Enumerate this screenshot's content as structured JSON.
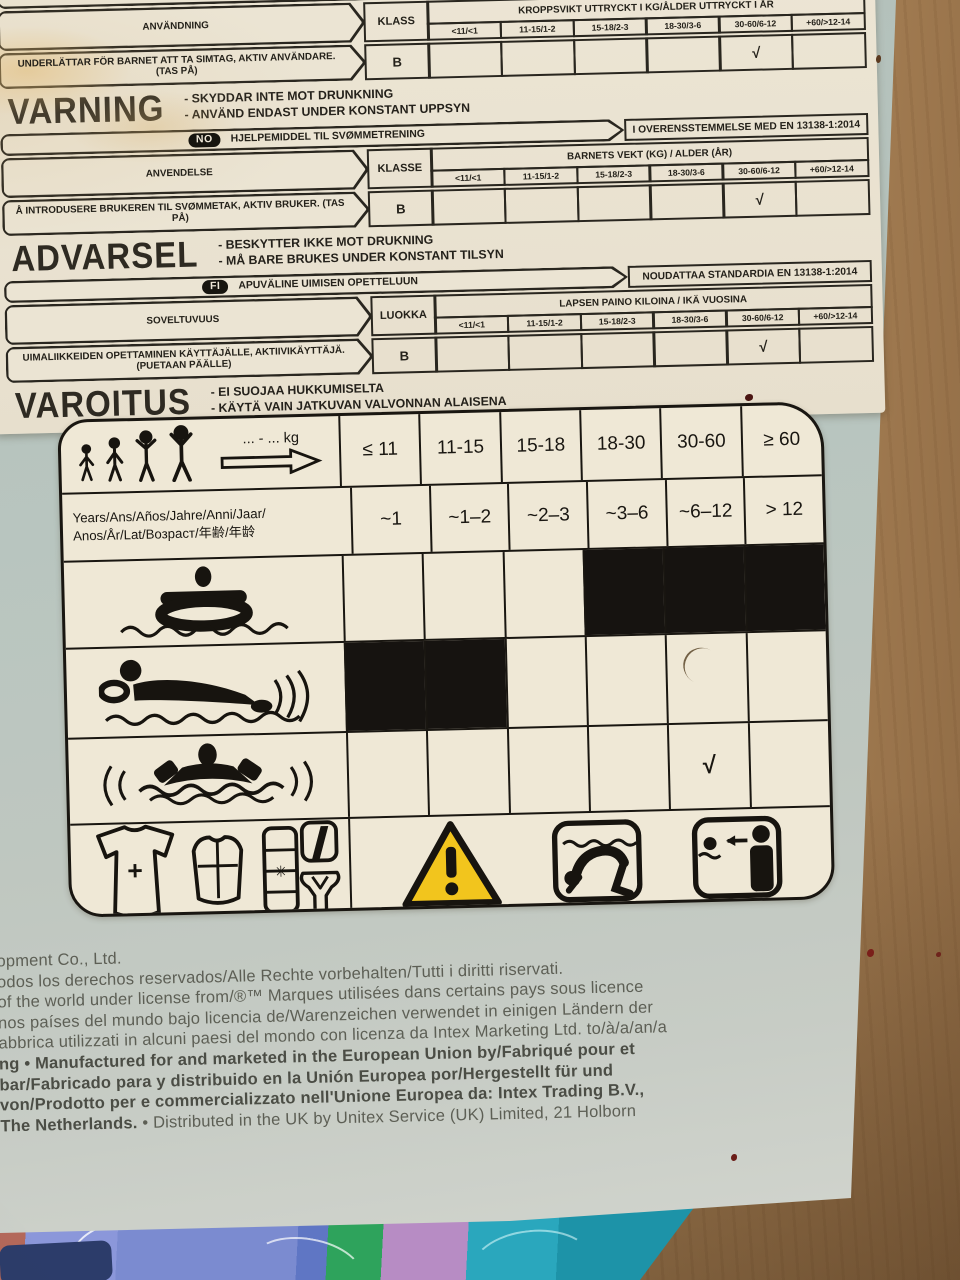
{
  "photo": {
    "scene": "photograph of an inflatable swim-aid product box lying on a wooden floor with patterned fabric at the bottom edge",
    "colors": {
      "label_bg": "#ebe4d2",
      "panel_bg": "#efe8d6",
      "box_bg": "#b6c2bb",
      "wood": "#b8916a",
      "ink": "#24211a",
      "legal_ink": "#5d5f55",
      "warning_yellow": "#f2c51d",
      "fabric_blue": "#7b8bd0",
      "fabric_teal": "#2aa7bd",
      "fabric_green": "#2ea35c",
      "fabric_pink": "#b78cc4",
      "fabric_navy": "#2c3c6a"
    }
  },
  "sv": {
    "product": "FLYTHJÄLPMEDEL TILL SIMTRÄNING",
    "standard": "",
    "usage_label": "ANVÄNDNING",
    "class_label": "KLASS",
    "class_value": "B",
    "weight_header": "KROPPSVIKT UTTRYCKT I KG/ÅLDER UTTRYCKT I ÅR",
    "ranges": [
      "<11/<1",
      "11-15/1-2",
      "15-18/2-3",
      "18-30/3-6",
      "30-60/6-12",
      "+60/>12-14"
    ],
    "usage_text": "UNDERLÄTTAR FÖR BARNET ATT TA SIMTAG, AKTIV ANVÄNDARE. (TAS PÅ)",
    "check_column": "30-60/6-12",
    "check_glyph": "√",
    "warning_word": "VARNING",
    "warning_lines": [
      "- SKYDDAR INTE MOT DRUNKNING",
      "- ANVÄND ENDAST UNDER KONSTANT UPPSYN"
    ]
  },
  "no": {
    "badge": "NO",
    "product": "HJELPEMIDDEL TIL SVØMMETRENING",
    "standard": "I OVERENSSTEMMELSE MED EN 13138-1:2014",
    "usage_label": "ANVENDELSE",
    "class_label": "KLASSE",
    "class_value": "B",
    "weight_header": "BARNETS VEKT (KG) / ALDER (ÅR)",
    "ranges": [
      "<11/<1",
      "11-15/1-2",
      "15-18/2-3",
      "18-30/3-6",
      "30-60/6-12",
      "+60/>12-14"
    ],
    "usage_text": "Å INTRODUSERE BRUKEREN TIL SVØMMETAK, AKTIV BRUKER. (TAS PÅ)",
    "check_column": "30-60/6-12",
    "check_glyph": "√",
    "warning_word": "ADVARSEL",
    "warning_lines": [
      "- BESKYTTER IKKE MOT DRUKNING",
      "- MÅ BARE BRUKES UNDER KONSTANT TILSYN"
    ]
  },
  "fi": {
    "badge": "FI",
    "product": "APUVÄLINE UIMISEN OPETTELUUN",
    "standard": "NOUDATTAA STANDARDIA EN 13138-1:2014",
    "usage_label": "SOVELTUVUUS",
    "class_label": "LUOKKA",
    "class_value": "B",
    "weight_header": "LAPSEN PAINO KILOINA / IKÄ VUOSINA",
    "ranges": [
      "<11/<1",
      "11-15/1-2",
      "15-18/2-3",
      "18-30/3-6",
      "30-60/6-12",
      "+60/>12-14"
    ],
    "usage_text": "UIMALIIKKEIDEN OPETTAMINEN KÄYTTÄJÄLLE, AKTIIVIKÄYTTÄJÄ. (PUETAAN PÄÄLLE)",
    "check_column": "30-60/6-12",
    "check_glyph": "√",
    "warning_word": "VAROITUS",
    "warning_lines": [
      "- EI SUOJAA HUKKUMISELTA",
      "- KÄYTÄ VAIN JATKUVAN VALVONNAN ALAISENA"
    ]
  },
  "pictogram": {
    "kg_label": "... - ... kg",
    "weights": [
      "≤ 11",
      "11-15",
      "15-18",
      "18-30",
      "30-60",
      "≥ 60"
    ],
    "years_label": "Years/Ans/Años/Jahre/Anni/Jaar/",
    "years_label2": "Anos/År/Lat/Возраст/年齢/年龄",
    "years": [
      "~1",
      "~1–2",
      "~2–3",
      "~3–6",
      "~6–12",
      "> 12"
    ],
    "check_glyph": "√",
    "matrix": [
      {
        "icon": "baby-swim-ring-icon",
        "cells": [
          "",
          "",
          "",
          "black",
          "black",
          "black"
        ]
      },
      {
        "icon": "swimming-with-armbands-icon",
        "cells": [
          "black",
          "black",
          "",
          "",
          "",
          ""
        ]
      },
      {
        "icon": "floating-with-armbands-icon",
        "cells": [
          "",
          "",
          "",
          "",
          "check",
          ""
        ]
      }
    ],
    "icons": [
      "growing-children-icon",
      "weight-range-arrow-icon",
      "baby-swim-ring-icon",
      "swimming-with-armbands-icon",
      "floating-with-armbands-icon",
      "swimsuit-icon",
      "swim-vest-icon",
      "armbands-stack-icon",
      "swim-seat-strap-icon",
      "swim-trainer-icon",
      "warning-triangle-icon",
      "no-diving-head-first-icon",
      "adult-supervision-icon"
    ]
  },
  "legal": {
    "lines": [
      {
        "b": "",
        "t": "opment Co., Ltd."
      },
      {
        "b": "",
        "t": "odos los derechos reservados/Alle Rechte vorbehalten/Tutti i diritti riservati."
      },
      {
        "b": "",
        "t": "of the world under license from/®™ Marques utilisées dans certains pays sous licence"
      },
      {
        "b": "",
        "t": "nos países del mundo bajo licencia de/Warenzeichen verwendet in einigen Ländern der"
      },
      {
        "b": "",
        "t": "abbrica utilizzati in alcuni paesi del mondo con licenza da Intex Marketing Ltd. to/à/a/an/a"
      },
      {
        "b": "ng • Manufactured for and marketed in the European Union by/Fabriqué pour et",
        "t": ""
      },
      {
        "b": "bar/Fabricado para y distribuido en la Unión Europea por/Hergestellt für und",
        "t": ""
      },
      {
        "b": "von/Prodotto per e commercializzato nell'Unione Europea da: Intex Trading B.V.,",
        "t": ""
      },
      {
        "b": "The Netherlands. ",
        "t": "• Distributed in the UK by Unitex Service (UK) Limited, 21 Holborn"
      }
    ]
  }
}
